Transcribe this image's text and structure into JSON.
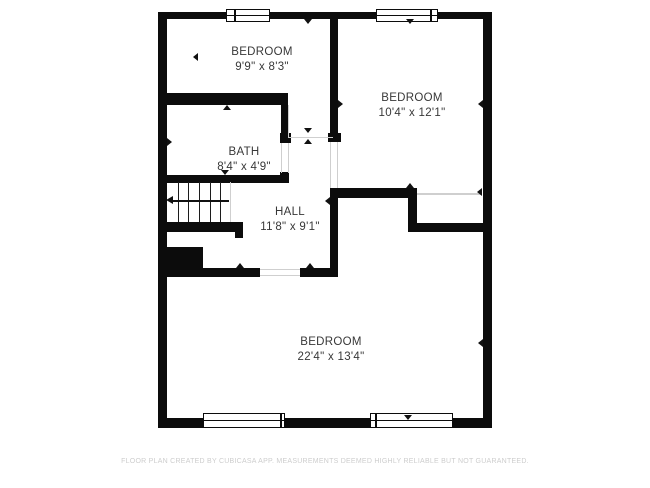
{
  "footer": {
    "text": "FLOOR PLAN CREATED BY CUBICASA APP. MEASUREMENTS DEEMED HIGHLY RELIABLE BUT NOT GUARANTEED."
  },
  "rooms": [
    {
      "id": "bedroom-1",
      "name": "BEDROOM",
      "dims": "9'9\" x 8'3\""
    },
    {
      "id": "bedroom-2",
      "name": "BEDROOM",
      "dims": "10'4\" x 12'1\""
    },
    {
      "id": "bath",
      "name": "BATH",
      "dims": "8'4\" x 4'9\""
    },
    {
      "id": "hall",
      "name": "HALL",
      "dims": "11'8\" x 9'1\""
    },
    {
      "id": "bedroom-3",
      "name": "BEDROOM",
      "dims": "22'4\" x 13'4\""
    }
  ],
  "colors": {
    "wall": "#0c0c0c",
    "label": "#383838",
    "opening_guide": "#cfcfcf",
    "footer": "#cdcdcd"
  },
  "geometry": {
    "walls": [
      [
        158,
        12,
        334,
        7
      ],
      [
        158,
        418,
        334,
        10
      ],
      [
        158,
        12,
        9,
        416
      ],
      [
        483,
        12,
        9,
        416
      ],
      [
        330,
        19,
        8,
        114
      ],
      [
        328,
        133,
        13,
        9
      ],
      [
        330,
        188,
        8,
        89
      ],
      [
        158,
        93,
        130,
        12
      ],
      [
        281,
        105,
        8,
        29
      ],
      [
        280,
        133,
        11,
        10
      ],
      [
        158,
        175,
        130,
        8
      ],
      [
        280,
        172,
        9,
        11
      ],
      [
        158,
        222,
        85,
        10
      ],
      [
        235,
        222,
        8,
        16
      ],
      [
        158,
        247,
        45,
        21
      ],
      [
        158,
        268,
        102,
        9
      ],
      [
        300,
        268,
        38,
        9
      ],
      [
        330,
        188,
        80,
        10
      ],
      [
        408,
        188,
        9,
        44
      ],
      [
        408,
        223,
        84,
        9
      ]
    ],
    "windows": [
      {
        "x": 226,
        "y": 9,
        "w": 44,
        "h": 13,
        "div": 234
      },
      {
        "x": 376,
        "y": 9,
        "w": 62,
        "h": 13,
        "div": 430
      },
      {
        "x": 203,
        "y": 413,
        "w": 82,
        "h": 15,
        "div": 280
      },
      {
        "x": 370,
        "y": 413,
        "w": 83,
        "h": 15,
        "div": 375
      }
    ],
    "openings": [
      [
        288,
        105,
        1,
        33
      ],
      [
        288,
        137,
        45,
        1
      ],
      [
        281,
        143,
        1,
        30
      ],
      [
        288,
        143,
        1,
        30
      ],
      [
        330,
        142,
        1,
        46
      ],
      [
        337,
        142,
        1,
        46
      ],
      [
        260,
        269,
        40,
        1
      ],
      [
        260,
        275,
        40,
        1
      ],
      [
        417,
        193,
        65,
        2
      ],
      [
        230,
        182,
        1,
        40
      ]
    ],
    "stairs": {
      "treads_x": [
        178,
        188,
        199,
        210,
        220
      ],
      "tread_top": 182,
      "tread_h": 40,
      "arrow_y": 200,
      "arrow_x1": 173,
      "arrow_x2": 229,
      "head_x": 166,
      "head_y": 196
    },
    "ticks": [
      {
        "x": 304,
        "y": 19,
        "dir": "down"
      },
      {
        "x": 406,
        "y": 19,
        "dir": "down"
      },
      {
        "x": 404,
        "y": 415,
        "dir": "down"
      },
      {
        "x": 304,
        "y": 128,
        "dir": "down"
      },
      {
        "x": 221,
        "y": 170,
        "dir": "down"
      },
      {
        "x": 223,
        "y": 105,
        "dir": "up"
      },
      {
        "x": 236,
        "y": 263,
        "dir": "up"
      },
      {
        "x": 306,
        "y": 263,
        "dir": "up"
      },
      {
        "x": 406,
        "y": 183,
        "dir": "up"
      },
      {
        "x": 304,
        "y": 139,
        "dir": "up"
      },
      {
        "x": 193,
        "y": 53,
        "dir": "left"
      },
      {
        "x": 478,
        "y": 100,
        "dir": "left"
      },
      {
        "x": 478,
        "y": 339,
        "dir": "left"
      },
      {
        "x": 477,
        "y": 188,
        "dir": "left"
      },
      {
        "x": 325,
        "y": 197,
        "dir": "left"
      },
      {
        "x": 167,
        "y": 138,
        "dir": "right"
      },
      {
        "x": 338,
        "y": 100,
        "dir": "right"
      }
    ]
  }
}
